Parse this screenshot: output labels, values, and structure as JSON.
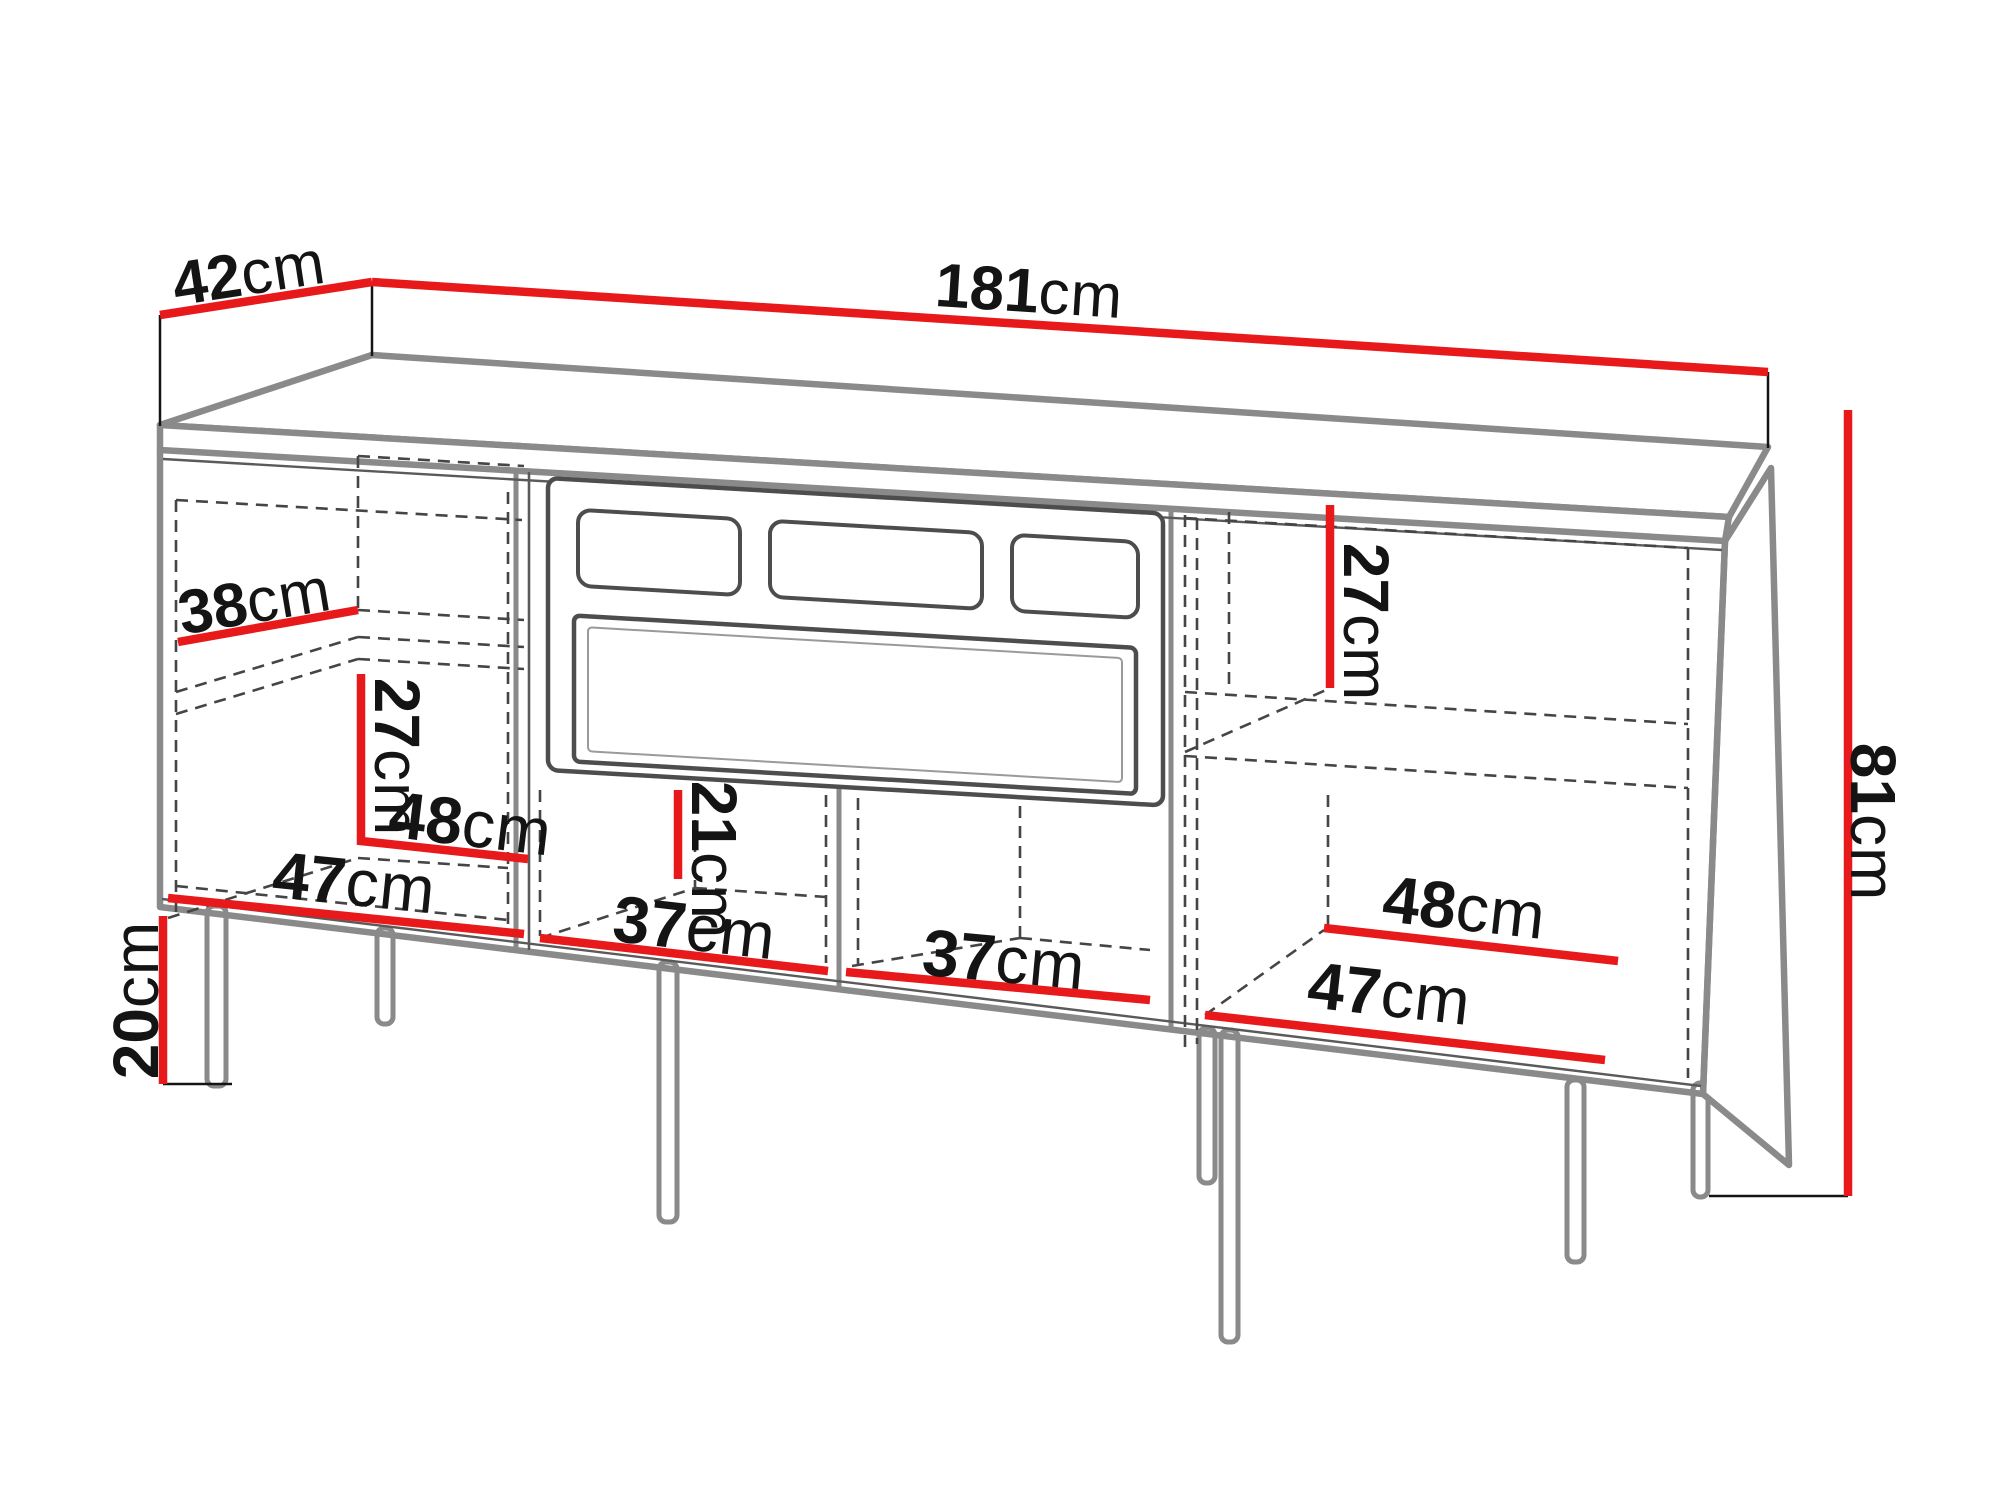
{
  "unit": "cm",
  "diagram_type": "furniture dimension line drawing",
  "subject": "TV stand / sideboard with fireplace insert, open compartments and metal legs",
  "labels": {
    "depth": "42",
    "width": "181",
    "height": "81",
    "leg_height": "20",
    "left_shelf_depth": "38",
    "left_lower_height": "27",
    "left_back_width": "48",
    "left_front_width": "47",
    "middle_niche_height": "21",
    "middle_left_niche_width": "37",
    "middle_right_niche_width": "37",
    "right_upper_height": "27",
    "right_back_width": "48",
    "right_front_width": "47"
  },
  "colors": {
    "dimension_line": "#E8191B",
    "outline": "#8A8A8A",
    "detail_line": "#4D4D4D",
    "dashed_line": "#454545",
    "tick_line": "#151515",
    "label_text": "#141414",
    "background": "#FFFFFF"
  }
}
